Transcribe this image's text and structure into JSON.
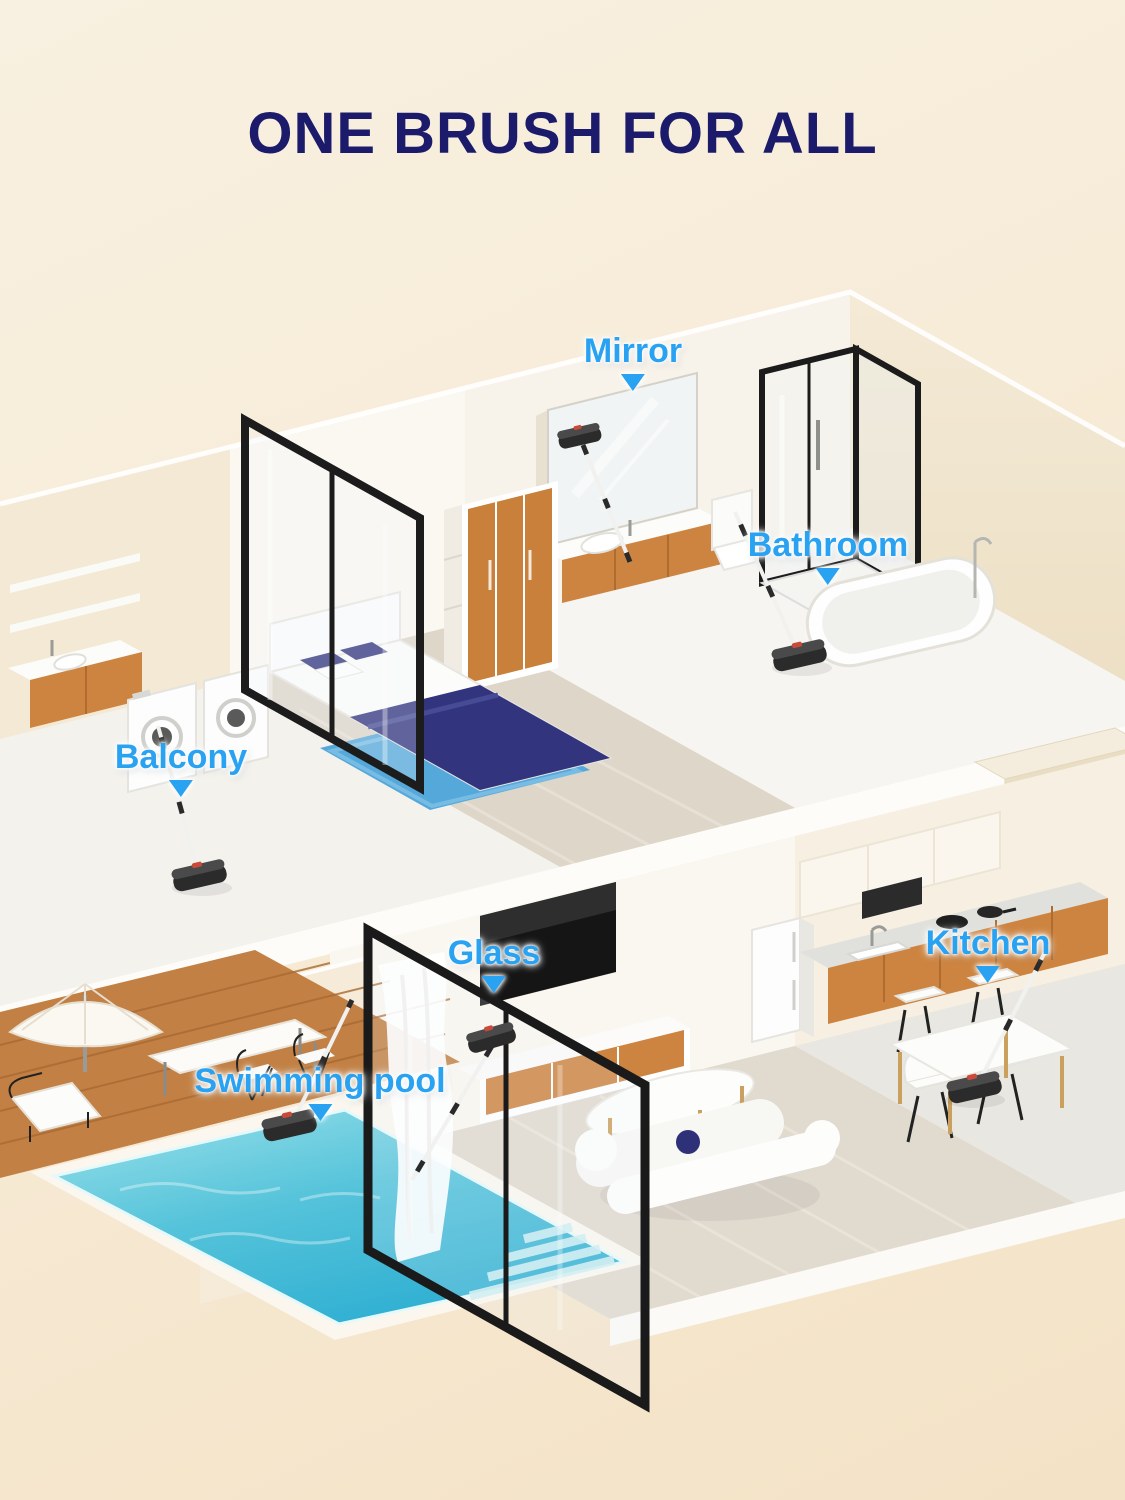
{
  "header": {
    "title": "ONE BRUSH FOR ALL"
  },
  "labels": [
    {
      "id": "mirror",
      "text": "Mirror"
    },
    {
      "id": "bathroom",
      "text": "Bathroom"
    },
    {
      "id": "balcony",
      "text": "Balcony"
    },
    {
      "id": "glass",
      "text": "Glass"
    },
    {
      "id": "kitchen",
      "text": "Kitchen"
    },
    {
      "id": "swimming-pool",
      "text": "Swimming pool"
    }
  ],
  "colors": {
    "title_navy": "#1b1a6b",
    "label_blue": "#29a2f2",
    "background_cream": "#f7ecd8",
    "wall_cream": "#f2e7d2",
    "wood_accent": "#cd8440",
    "bedding_navy": "#32357e",
    "rug_blue": "#55a8da",
    "pool_water": "#45bcd8",
    "deck_wood": "#c28044",
    "frame_black": "#1d1d1d"
  }
}
